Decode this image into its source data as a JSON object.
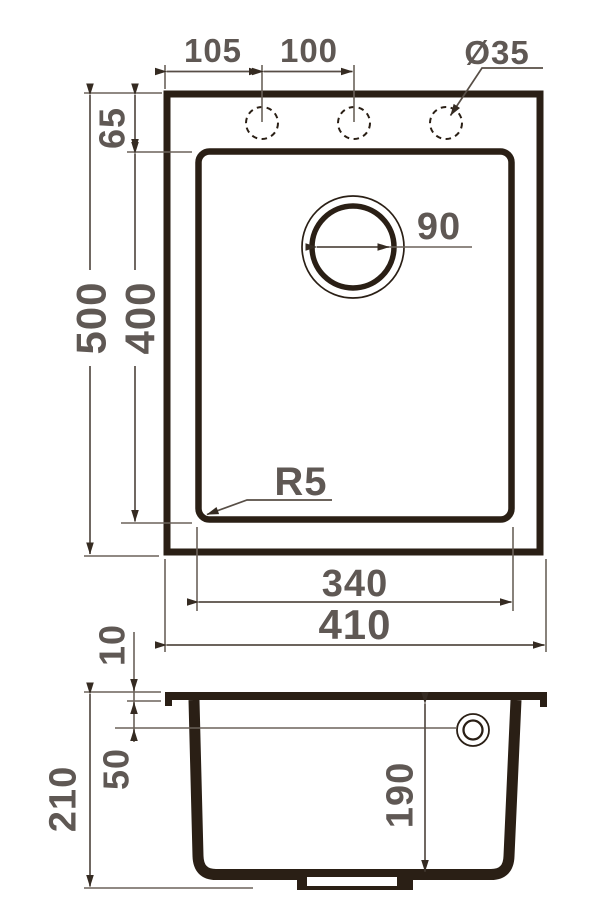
{
  "drawing": {
    "title": "sink-dimension-drawing",
    "plan_view": {
      "labels": {
        "hole_spacing_left": "105",
        "hole_spacing_right": "100",
        "hole_diameter": "Ø35",
        "rim_top_offset": "65",
        "overall_depth": "500",
        "bowl_depth": "400",
        "drain_diameter": "90",
        "corner_radius": "R5",
        "bowl_width": "340",
        "overall_width": "410"
      }
    },
    "section_view": {
      "labels": {
        "rim_thickness": "10",
        "overflow_offset": "50",
        "overall_height": "210",
        "bowl_height": "190"
      }
    },
    "colors": {
      "ink": "#2a1f15",
      "dim_line": "#6b625a",
      "arrow": "#352b22",
      "text": "#5f5854",
      "background": "#ffffff"
    }
  }
}
